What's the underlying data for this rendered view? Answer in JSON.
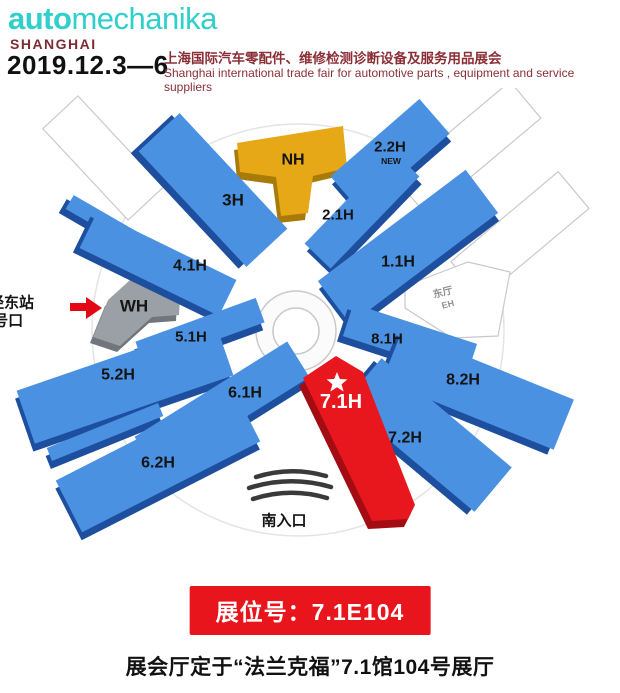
{
  "header": {
    "logo_auto": "auto",
    "logo_mechanika": "mechanika",
    "logo_city": "SHANGHAI",
    "date": "2019.12.3—6",
    "subtitle_cn": "上海国际汽车零配件、维修检测诊断设备及服务用品展会",
    "subtitle_en": "Shanghai international trade fair for automotive  parts , equipment and service suppliers"
  },
  "map": {
    "labels": {
      "h3": "3H",
      "nh": "NH",
      "h22": "2.2H",
      "h22_tag": "NEW",
      "h21": "2.1H",
      "h11": "1.1H",
      "h41": "4.1H",
      "wh": "WH",
      "h51": "5.1H",
      "h52": "5.2H",
      "h61": "6.1H",
      "h62": "6.2H",
      "h71": "7.1H",
      "h72": "7.2H",
      "h81": "8.1H",
      "h82": "8.2H",
      "east_hall": "东厅",
      "east_hall_abbr": "EH",
      "south_entrance": "南入口"
    },
    "station": {
      "line1": "徐泾东站",
      "line2": "6号口"
    },
    "highlighted_hall": "7.1H"
  },
  "booth": {
    "label": "展位号：7.1E104"
  },
  "footer": {
    "note": "展会厅定于“法兰克福”7.1馆104号展厅"
  },
  "colors": {
    "brand_teal": "#2fd0cb",
    "maroon": "#7d2b35",
    "hall_blue": "#4a91e2",
    "hall_blue_side": "#1d4f9e",
    "hall_red": "#e8161d",
    "hall_gold": "#e6a817",
    "hall_gray": "#9aa0a5",
    "badge_red": "#e8151c",
    "arrow_red": "#e30613"
  }
}
